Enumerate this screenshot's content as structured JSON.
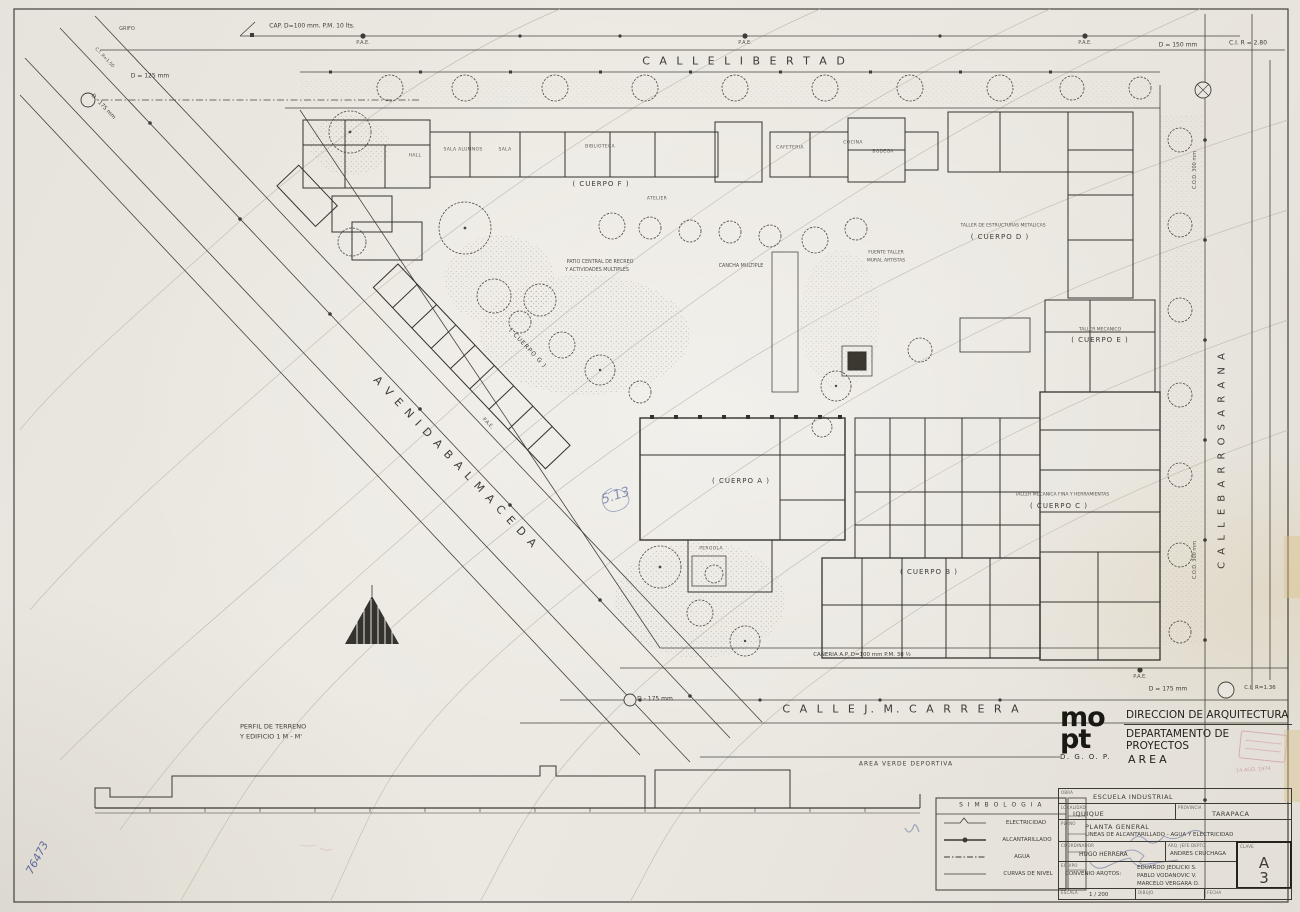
{
  "sheet_title": "PLANTA GENERAL - ESCUELA INDUSTRIAL IQUIQUE",
  "streets": {
    "libertad": "C A L L E   L I B E R T A D",
    "balmaceda": "A V E N I D A   B A L M A C E D A",
    "carrera": "C A L L E   J. M.   C A R R E R A",
    "barros_arana": "C A L L E   B A R R O S   A R A N A"
  },
  "utilities": {
    "cap_top": "CAP.  D=100 mm.  P.M.  10 lts.",
    "grifo": "GRIFO",
    "pae": "P.A.E.",
    "d125": "D = 125 mm",
    "d175_diag": "D - 175 mm",
    "ci_150": "C.I.  R=1.50",
    "d150": "D = 150 mm",
    "ci_280": "C.I.  R = 2.80",
    "caneria_ap": "CAÑERIA  A.P.  D=100 mm  P.M.  38 ½",
    "d175_bottom": "D = 175 mm",
    "ci_136": "C.I.  R=1.36",
    "d175_bl": "D - 175 mm",
    "cod300": "C.O.D.  300 mm"
  },
  "cuerpos": {
    "a": "( CUERPO  A )",
    "b": "( CUERPO  B )",
    "c": "( CUERPO  C )",
    "c_title": "TALLER  MECANICA  FINA  Y  HERRAMIENTAS",
    "d": "( CUERPO  D )",
    "d_title": "TALLER  DE  ESTRUCTURAS  METALICAS",
    "e": "( CUERPO  E )",
    "e_title": "TALLER  MECANICO",
    "f": "( CUERPO  F )",
    "g": "( CUERPO  G )"
  },
  "areas": {
    "patio_line1": "PATIO  CENTRAL  DE  RECREO",
    "patio_line2": "Y  ACTIVIDADES  MULTIPLES",
    "cancha": "CANCHA  MULTIPLE",
    "fuente_line1": "FUENTE  TALLER",
    "fuente_line2": "MURAL  ARTISTAS",
    "verde": "AREA  VERDE  DEPORTIVA"
  },
  "rooms": [
    "SALA ALUMNOS",
    "SALA",
    "BIBLIOTECA",
    "CAFETERIA",
    "COCINA",
    "BODEGA",
    "HALL",
    "ATELIER",
    "PERGOLA"
  ],
  "profile": {
    "line1": "PERFIL  DE  TERRENO",
    "line2": "Y  EDIFICIO 1   M - M'"
  },
  "legend": {
    "title": "S I M B O L O G I A",
    "items": [
      {
        "label": "ELECTRICIDAD"
      },
      {
        "label": "ALCANTARILLADO"
      },
      {
        "label": "AGUA"
      },
      {
        "label": "CURVAS  DE  NIVEL"
      }
    ]
  },
  "title_block": {
    "logo_line1": "mo",
    "logo_line2": "pt",
    "logo_sub": "D. G. O. P.",
    "dir1": "DIRECCION  DE  ARQUITECTURA",
    "dir2": "DEPARTAMENTO  DE  PROYECTOS",
    "area": "AREA",
    "stamp_date": "14 AGO. 1974",
    "fields": {
      "obra_label": "OBRA",
      "obra": "ESCUELA    INDUSTRIAL",
      "localidad_label": "LOCALIDAD",
      "localidad": "IQUIQUE",
      "provincia_label": "PROVINCIA",
      "provincia": "TARAPACA",
      "plano_label": "PLANO",
      "plano1": "PLANTA    GENERAL",
      "plano2": "LINEAS  DE  ALCANTARILLADO - AGUA  Y  ELECTRICIDAD",
      "coordinador_label": "COORDINADOR",
      "coordinador": "HUGO  HERRERA",
      "arq_jefe_label": "ARQ. JEFE DEPTO.",
      "arq_jefe": "ANDRES  CRUCHAGA",
      "equipo_label": "EQUIPO",
      "equipo_prefix": "CONVENIO  ARQTOS:",
      "equipo_names": [
        "EDUARDO   JEDLICKI  S.",
        "PABLO   VODANOVIC  V.",
        "MARCELO   VERGARA  O."
      ],
      "clave_label": "CLAVE",
      "clave_letter": "A",
      "clave_number": "3",
      "escala_label": "ESCALA",
      "escala": "1 / 200",
      "dibujo_label": "DIBUJO",
      "fecha_label": "FECHA"
    }
  },
  "handwriting": {
    "margin_number": "76473",
    "pencil_note": "5.13"
  },
  "colors": {
    "paper": "#e9e6df",
    "ink": "#3e3c36",
    "faint": "#b7b1a4",
    "stamp_pink": "#c4798b",
    "pencil_blue": "#5d6b9e"
  }
}
